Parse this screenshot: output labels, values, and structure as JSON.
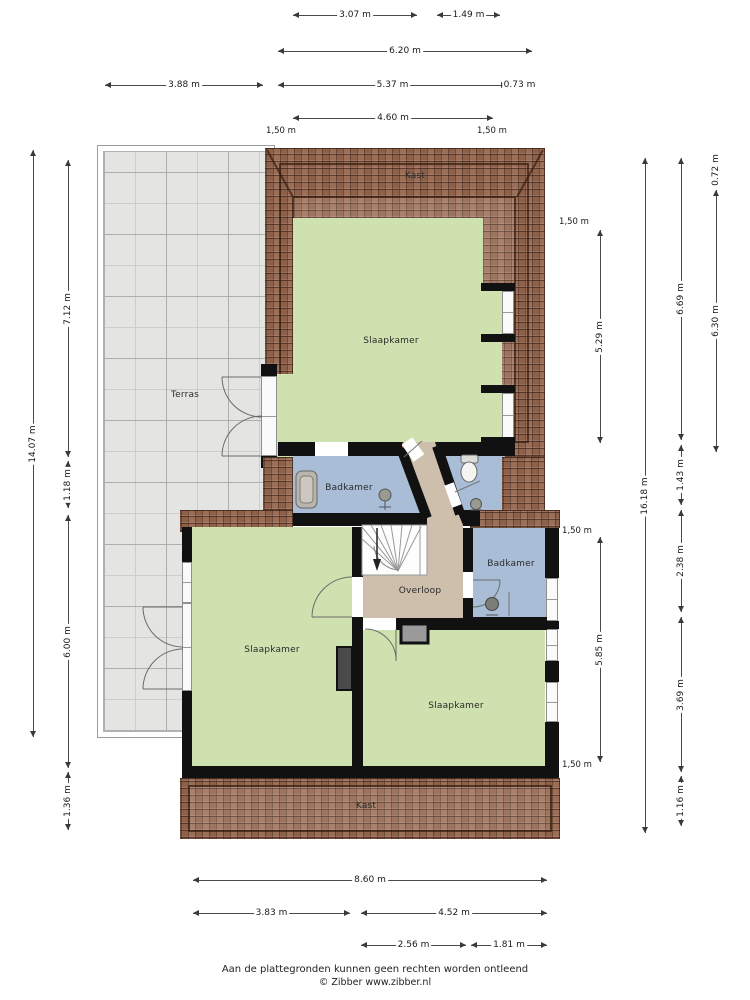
{
  "rooms": [
    {
      "id": "kast-top",
      "label": "Kast",
      "x": 415,
      "y": 176
    },
    {
      "id": "slaapkamer-top",
      "label": "Slaapkamer",
      "x": 391,
      "y": 341
    },
    {
      "id": "terras",
      "label": "Terras",
      "x": 185,
      "y": 395
    },
    {
      "id": "badkamer-left",
      "label": "Badkamer",
      "x": 349,
      "y": 488
    },
    {
      "id": "badkamer-right",
      "label": "Badkamer",
      "x": 511,
      "y": 564
    },
    {
      "id": "overloop",
      "label": "Overloop",
      "x": 420,
      "y": 591
    },
    {
      "id": "slaapkamer-left",
      "label": "Slaapkamer",
      "x": 272,
      "y": 650
    },
    {
      "id": "slaapkamer-right",
      "label": "Slaapkamer",
      "x": 456,
      "y": 706
    },
    {
      "id": "kast-bottom",
      "label": "Kast",
      "x": 366,
      "y": 806
    }
  ],
  "dimensions": [
    {
      "label": "3.07 m",
      "orient": "h",
      "from": 293,
      "to": 417,
      "at": 15
    },
    {
      "label": "1.49 m",
      "orient": "h",
      "from": 437,
      "to": 500,
      "at": 15
    },
    {
      "label": "6.20 m",
      "orient": "h",
      "from": 278,
      "to": 532,
      "at": 51
    },
    {
      "label": "3.88 m",
      "orient": "h",
      "from": 105,
      "to": 263,
      "at": 85
    },
    {
      "label": "5.37 m",
      "orient": "h",
      "from": 278,
      "to": 507,
      "at": 85
    },
    {
      "label": "0.73 m",
      "orient": "h",
      "from": 507,
      "to": 532,
      "at": 85
    },
    {
      "label": "4.60 m",
      "orient": "h",
      "from": 293,
      "to": 493,
      "at": 118
    },
    {
      "label": "14.07 m",
      "orient": "v",
      "from": 150,
      "to": 737,
      "at": 33
    },
    {
      "label": "7.12 m",
      "orient": "v",
      "from": 160,
      "to": 457,
      "at": 68
    },
    {
      "label": "1.18 m",
      "orient": "v",
      "from": 461,
      "to": 508,
      "at": 68
    },
    {
      "label": "6.00 m",
      "orient": "v",
      "from": 515,
      "to": 768,
      "at": 68
    },
    {
      "label": "1.36 m",
      "orient": "v",
      "from": 772,
      "to": 830,
      "at": 68
    },
    {
      "label": "5.29 m",
      "orient": "v",
      "from": 230,
      "to": 443,
      "at": 600
    },
    {
      "label": "5.85 m",
      "orient": "v",
      "from": 537,
      "to": 762,
      "at": 600
    },
    {
      "label": "16.18 m",
      "orient": "v",
      "from": 158,
      "to": 833,
      "at": 645
    },
    {
      "label": "6.69 m",
      "orient": "v",
      "from": 158,
      "to": 440,
      "at": 681
    },
    {
      "label": "1.43 m",
      "orient": "v",
      "from": 445,
      "to": 505,
      "at": 681
    },
    {
      "label": "2.38 m",
      "orient": "v",
      "from": 510,
      "to": 612,
      "at": 681
    },
    {
      "label": "3.69 m",
      "orient": "v",
      "from": 617,
      "to": 772,
      "at": 681
    },
    {
      "label": "1.16 m",
      "orient": "v",
      "from": 776,
      "to": 826,
      "at": 681
    },
    {
      "label": "0.72 m",
      "orient": "v",
      "from": 155,
      "to": 185,
      "at": 716
    },
    {
      "label": "6.30 m",
      "orient": "v",
      "from": 190,
      "to": 452,
      "at": 716
    },
    {
      "label": "8.60 m",
      "orient": "h",
      "from": 193,
      "to": 547,
      "at": 880
    },
    {
      "label": "3.83 m",
      "orient": "h",
      "from": 193,
      "to": 350,
      "at": 913
    },
    {
      "label": "4.52 m",
      "orient": "h",
      "from": 361,
      "to": 547,
      "at": 913
    },
    {
      "label": "2.56 m",
      "orient": "h",
      "from": 361,
      "to": 466,
      "at": 945
    },
    {
      "label": "1.81 m",
      "orient": "h",
      "from": 471,
      "to": 547,
      "at": 945
    }
  ],
  "height_markers": [
    {
      "label": "1,50 m",
      "x": 281,
      "y": 131
    },
    {
      "label": "1,50 m",
      "x": 492,
      "y": 131
    },
    {
      "label": "1,50 m",
      "x": 574,
      "y": 222
    },
    {
      "label": "1,50 m",
      "x": 577,
      "y": 531
    },
    {
      "label": "1,50 m",
      "x": 577,
      "y": 765
    }
  ],
  "footer": {
    "line1": "Aan de plattegronden kunnen geen rechten worden ontleend",
    "line2": "© Zibber www.zibber.nl"
  },
  "colors": {
    "room_green": "#cfe1af",
    "room_blue": "#a9bdd7",
    "room_tan": "#cdbfab",
    "brick": "#96664f",
    "wall": "#111111",
    "terrace": "#e4e4e2"
  }
}
